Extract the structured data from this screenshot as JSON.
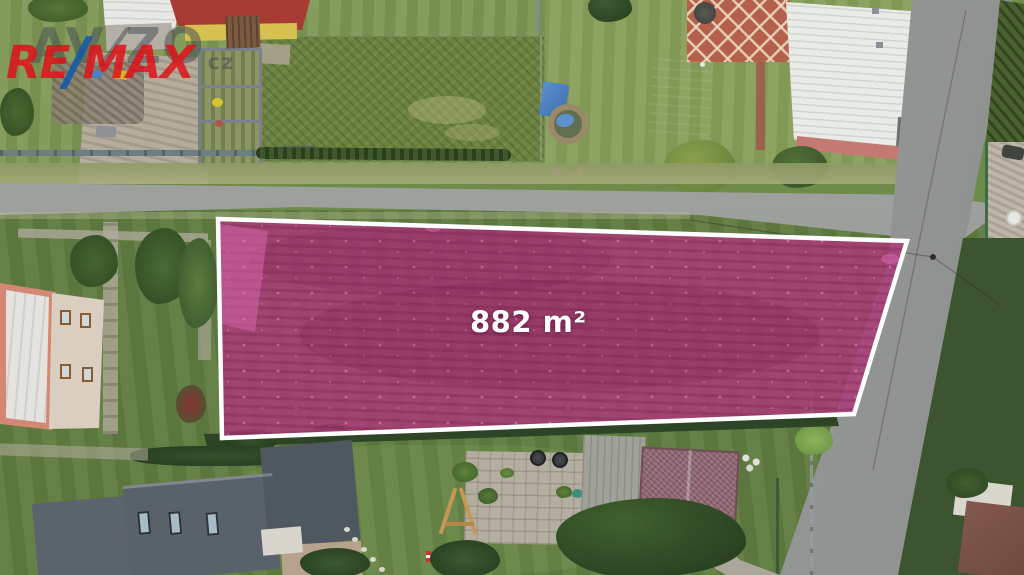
{
  "scene": {
    "description": "Aerial drone photo of a building plot highlighted for sale",
    "plot": {
      "area_label": "882 m²",
      "fill_color": "#ad3877",
      "highlight_color": "#d867ae",
      "border_color": "#ffffff"
    },
    "watermarks": {
      "avizo": {
        "pre": "AV",
        "slash": "/",
        "post": "ZO",
        "tld": "cz",
        "text_color": "#464c54",
        "slash_color": "#464c54"
      },
      "remax": {
        "pre": "RE",
        "slash": "/",
        "post": "MAX",
        "text_color": "#df121a",
        "slash_color": "#1458aa"
      }
    },
    "colors": {
      "grass": "#6f8b49",
      "road": "#9b9d9c",
      "hedge": "#2d4426",
      "roof_dark": "#59616a",
      "roof_red": "#a83c34",
      "roof_white": "#e9ebe7"
    }
  }
}
